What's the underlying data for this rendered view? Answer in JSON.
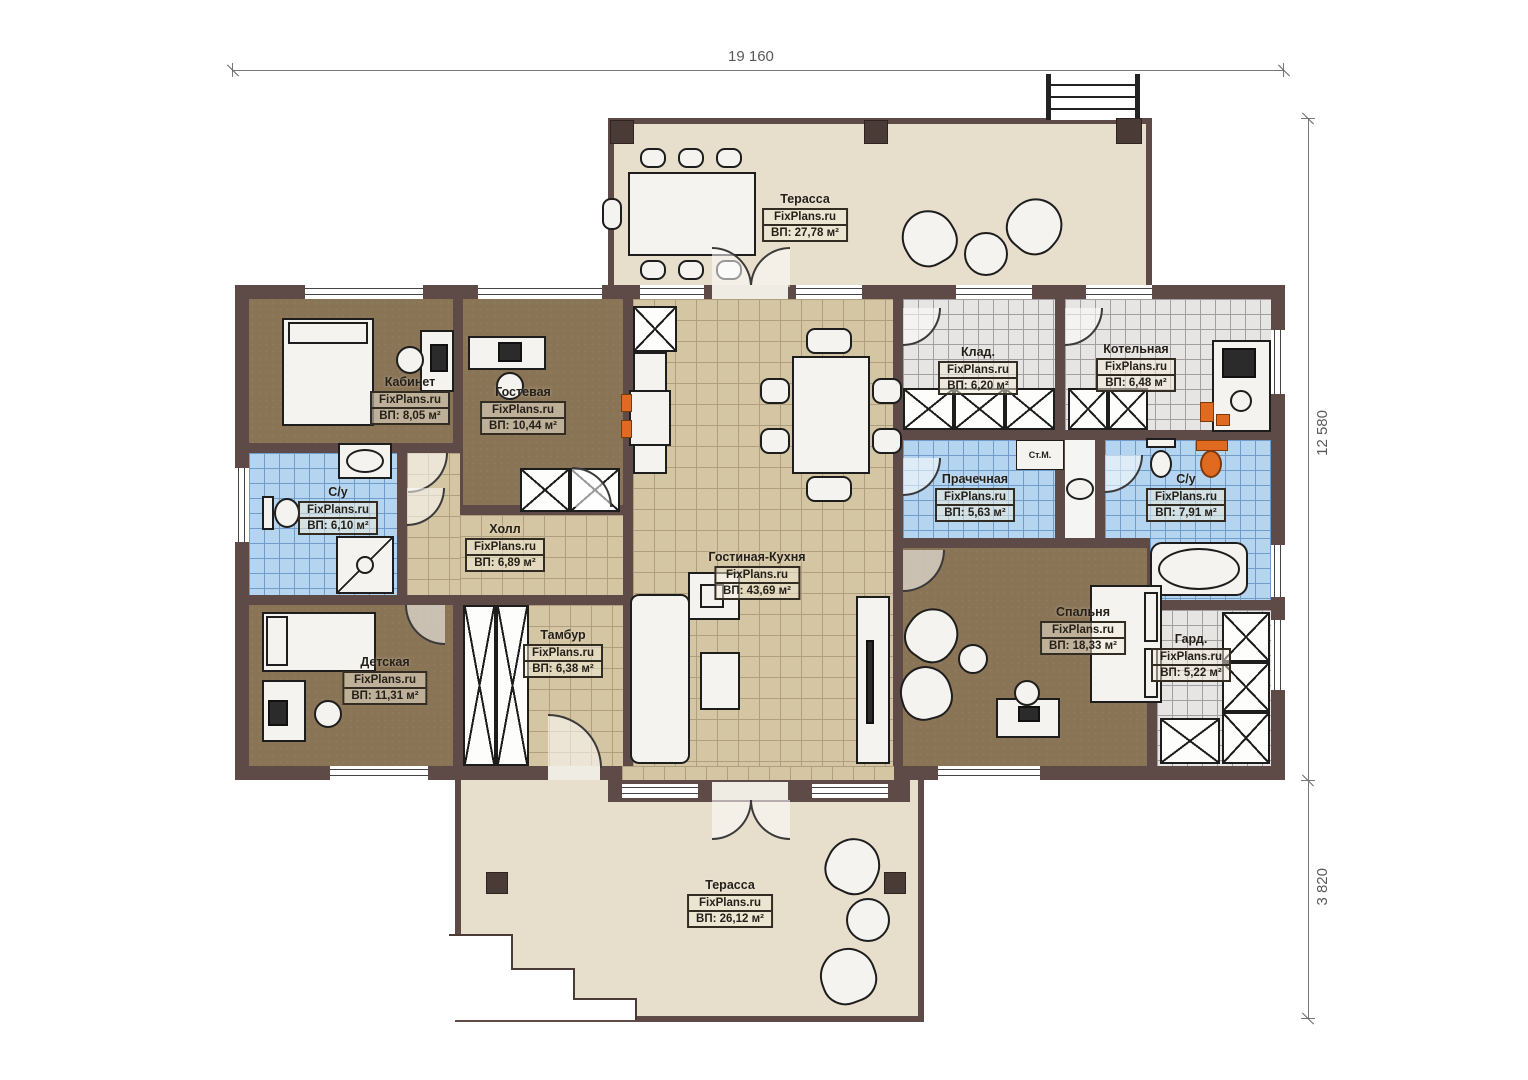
{
  "plan": {
    "brand": "FixPlans.ru",
    "dimensions": {
      "top_width": "19 160",
      "right_height_main": "12 580",
      "right_height_terrace": "3 820"
    },
    "annotations": {
      "washing_machine": "Ст.М."
    },
    "colors": {
      "wall": "#5e4b48",
      "terrace_floor": "#e7decb",
      "tile_tan": "#d5c6a3",
      "room_brown": "#8a7456",
      "tile_blue": "#b5d4ef",
      "tile_gray": "#e6e5e3",
      "accent_orange": "#e06a1f"
    },
    "rooms": [
      {
        "id": "terrace-top",
        "name": "Терасса",
        "brand": "FixPlans.ru",
        "area": "ВП: 27,78 м²"
      },
      {
        "id": "kabinet",
        "name": "Кабинет",
        "brand": "FixPlans.ru",
        "area": "ВП: 8,05 м²"
      },
      {
        "id": "gostevaya",
        "name": "Гостевая",
        "brand": "FixPlans.ru",
        "area": "ВП: 10,44 м²"
      },
      {
        "id": "su-left",
        "name": "С/у",
        "brand": "FixPlans.ru",
        "area": "ВП: 6,10 м²"
      },
      {
        "id": "hall",
        "name": "Холл",
        "brand": "FixPlans.ru",
        "area": "ВП: 6,89 м²"
      },
      {
        "id": "living-kitchen",
        "name": "Гостиная-Кухня",
        "brand": "FixPlans.ru",
        "area": "ВП: 43,69 м²"
      },
      {
        "id": "klad",
        "name": "Клад.",
        "brand": "FixPlans.ru",
        "area": "ВП: 6,20 м²"
      },
      {
        "id": "kotelnaya",
        "name": "Котельная",
        "brand": "FixPlans.ru",
        "area": "ВП: 6,48 м²"
      },
      {
        "id": "prachechnaya",
        "name": "Прачечная",
        "brand": "FixPlans.ru",
        "area": "ВП: 5,63 м²"
      },
      {
        "id": "su-right",
        "name": "С/у",
        "brand": "FixPlans.ru",
        "area": "ВП: 7,91 м²"
      },
      {
        "id": "spalnya",
        "name": "Спальня",
        "brand": "FixPlans.ru",
        "area": "ВП: 18,33 м²"
      },
      {
        "id": "gard",
        "name": "Гард.",
        "brand": "FixPlans.ru",
        "area": "ВП: 5,22 м²"
      },
      {
        "id": "detskaya",
        "name": "Детская",
        "brand": "FixPlans.ru",
        "area": "ВП: 11,31 м²"
      },
      {
        "id": "tambur",
        "name": "Тамбур",
        "brand": "FixPlans.ru",
        "area": "ВП: 6,38 м²"
      },
      {
        "id": "terrace-bottom",
        "name": "Терасса",
        "brand": "FixPlans.ru",
        "area": "ВП: 26,12 м²"
      }
    ]
  }
}
